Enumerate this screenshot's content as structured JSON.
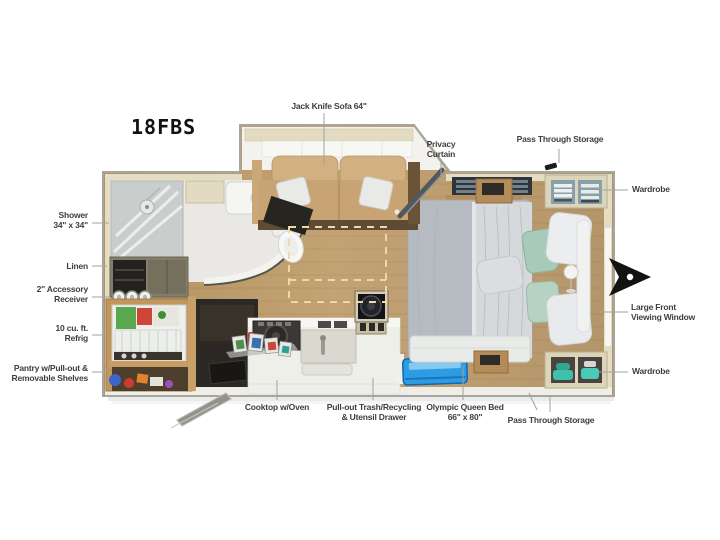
{
  "title": {
    "model": "18FBS"
  },
  "labels": {
    "jack_knife_sofa": "Jack Knife Sofa 64\"",
    "privacy_curtain": "Privacy\nCurtain",
    "pass_through_storage_top": "Pass Through Storage",
    "wardrobe_top": "Wardrobe",
    "shower": "Shower\n34\" x 34\"",
    "linen": "Linen",
    "accessory_receiver": "2\" Accessory\nReceiver",
    "refrigerator": "10 cu. ft.\nRefrig",
    "pantry": "Pantry w/Pull-out &\nRemovable Shelves",
    "cooktop": "Cooktop w/Oven",
    "trash_drawer": "Pull-out Trash/Recycling\n& Utensil Drawer",
    "queen_bed": "Olympic Queen Bed\n66\" x 80\"",
    "pass_through_storage_bottom": "Pass Through Storage",
    "wardrobe_bottom": "Wardrobe",
    "front_window": "Large Front\nViewing Window"
  },
  "colors": {
    "background": "#ffffff",
    "wood_floor": "#bd9d6f",
    "wall_beige": "#e4ddc2",
    "sofa_tan": "#d3b081",
    "bed_gray": "#b6bbc1",
    "pillow_teal": "#a8cab8",
    "storage_blue": "#2c9ce4",
    "label_text": "#3e3e3e",
    "hitch_black": "#131311"
  }
}
